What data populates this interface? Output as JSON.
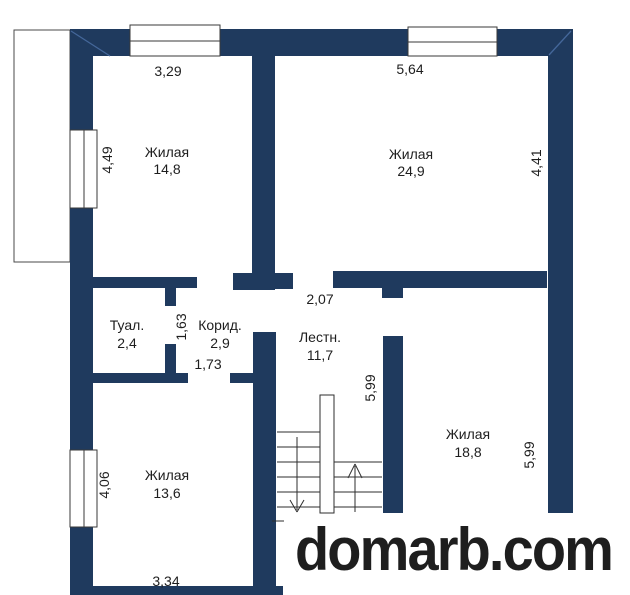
{
  "plan": {
    "wall_color": "#1f3a5e",
    "watermark": {
      "text": "domarb.com",
      "color": "#8e1111"
    },
    "rooms": {
      "living_top_left": {
        "name": "Жилая",
        "area": "14,8"
      },
      "living_top_right": {
        "name": "Жилая",
        "area": "24,9"
      },
      "toilet": {
        "name": "Туал.",
        "area": "2,4"
      },
      "corridor": {
        "name": "Корид.",
        "area": "2,9"
      },
      "stairs": {
        "name": "Лестн.",
        "area": "11,7"
      },
      "living_right": {
        "name": "Жилая",
        "area": "18,8"
      },
      "living_bottom_left": {
        "name": "Жилая",
        "area": "13,6"
      }
    },
    "dimensions": {
      "window_top_left": "3,29",
      "window_top_right": "5,64",
      "window_left_upper": "4,49",
      "wall_right_upper": "4,41",
      "opening_hall": "2,07",
      "corridor_width": "1,63",
      "corridor_door": "1,73",
      "stairs_depth": "5,99",
      "room_right_depth": "5,99",
      "window_left_lower": "4,06",
      "room_bottom_width": "3,34"
    }
  }
}
